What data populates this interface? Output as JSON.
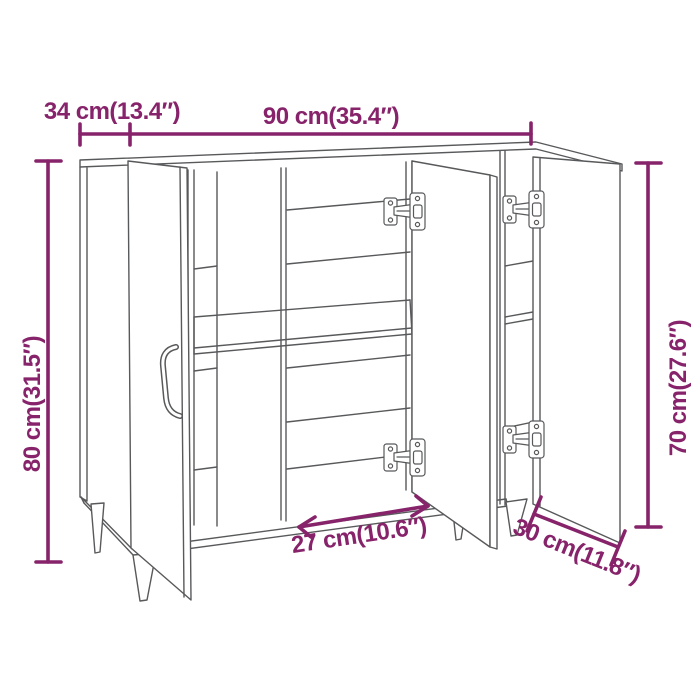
{
  "diagram": {
    "type": "product-dimension-diagram",
    "subject": "sideboard with three open doors, shelves, hinges and tapered legs",
    "accent_color": "#87236A",
    "line_color": "#58595B",
    "background_color": "#FFFFFF",
    "dimensions": {
      "top_depth": {
        "cm": 34,
        "in": 13.4,
        "label": "34 cm(13.4″)"
      },
      "width": {
        "cm": 90,
        "in": 35.4,
        "label": "90 cm(35.4″)"
      },
      "height": {
        "cm": 80,
        "in": 31.5,
        "label": "80 cm(31.5″)"
      },
      "door_height": {
        "cm": 70,
        "in": 27.6,
        "label": "70 cm(27.6″)"
      },
      "inner_width": {
        "cm": 27,
        "in": 10.6,
        "label": "27 cm(10.6″)"
      },
      "bottom_depth": {
        "cm": 30,
        "in": 11.8,
        "label": "30 cm(11.8″)"
      }
    }
  }
}
